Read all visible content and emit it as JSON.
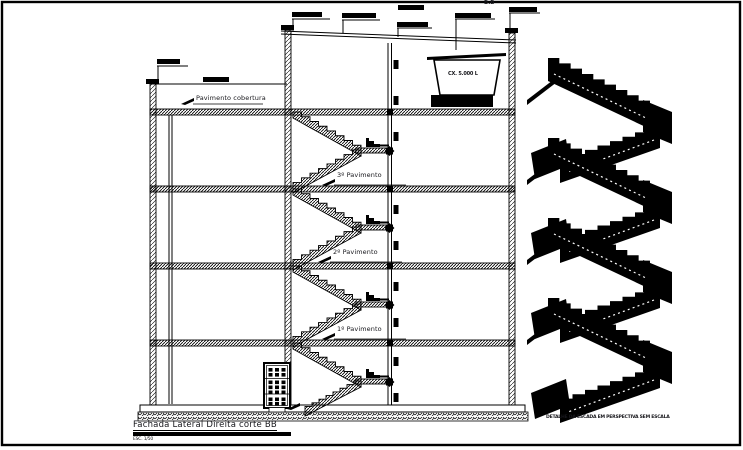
{
  "sheet": {
    "title": "Fachada Lateral Direita corte BB",
    "scale": "ESC. 1/50",
    "section_marker": "B.B"
  },
  "section": {
    "label_roof": "Pavimento cobertura",
    "label_floor3": "3º Pavimento",
    "label_floor2": "2º Pavimento",
    "label_floor1": "1º Pavimento",
    "water_tank_text": "CX. 5.000 L"
  },
  "perspective": {
    "caption": "DETALHE DA ESCADA EM PERSPECTIVA SEM ESCALA"
  },
  "colors": {
    "ink": "#000000",
    "paper": "#ffffff"
  }
}
